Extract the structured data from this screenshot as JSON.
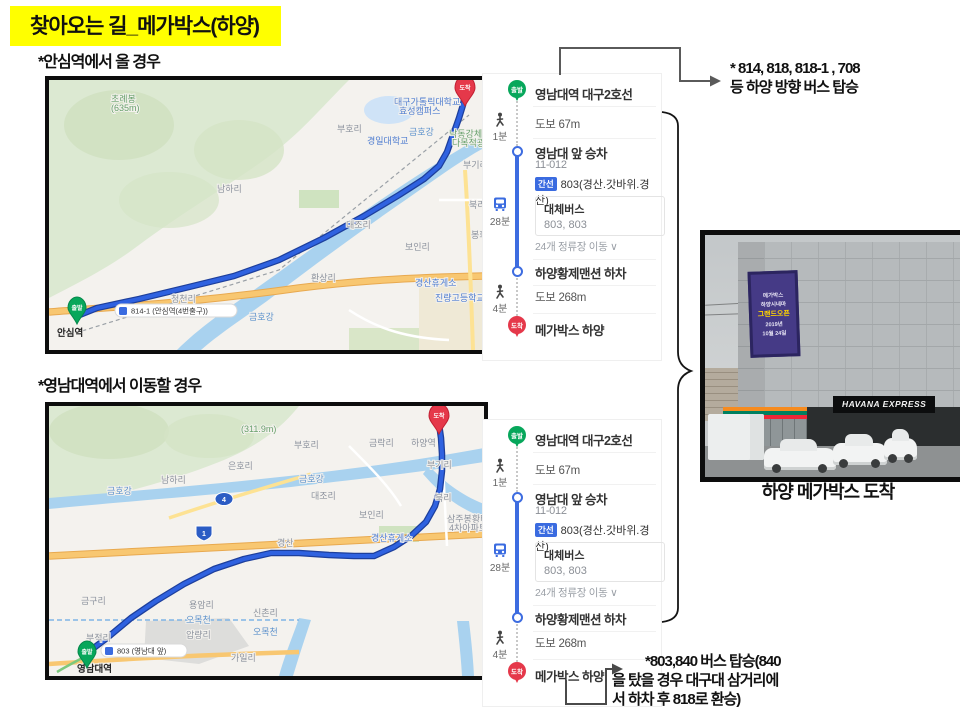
{
  "title": "찾아오는 길_메가박스(하양)",
  "section1": {
    "subtitle": "*안심역에서 올 경우"
  },
  "section2": {
    "subtitle": "*영남대역에서 이동할 경우"
  },
  "transit": {
    "start_pin": "출발",
    "start_station": "영남대역 대구2호선",
    "walk1_time": "1분",
    "walk1_dist": "도보 67m",
    "board_stop": "영남대 앞 승차",
    "board_code": "11-012",
    "line_badge": "간선",
    "line_name": "803(경산.갓바위.경산)",
    "bus_time": "28분",
    "alt_label": "대체버스",
    "alt_buses": "803, 803",
    "stops_toggle": "24개 정류장 이동 ∨",
    "alight_stop": "하양황제맨션 하차",
    "walk2_time": "4분",
    "walk2_dist": "도보 268m",
    "dest_pin": "도착",
    "dest_name": "메가박스 하양"
  },
  "annotation_top": {
    "line1": "* 814, 818, 818-1 , 708",
    "line2": "등 하양 방향 버스 탑승"
  },
  "annotation_bottom": {
    "line1": "*803,840 버스 탑승(840",
    "line2": "을 탔을 경우 대구대 삼거리에",
    "line3": "서 하차 후 818로 환승)"
  },
  "photo": {
    "caption": "하양 메가박스 도착",
    "sign": "HAVANA EXPRESS",
    "banner": {
      "l1": "메가박스",
      "l2": "하양시네마",
      "l3": "그랜드오픈",
      "l4": "2019년",
      "l5": "10월 24일"
    }
  },
  "colors": {
    "highlight": "#ffff00",
    "route": "#2f62e0",
    "route_casing": "#1d3f9c",
    "start_pin": "#07a75b",
    "dest_pin": "#e5384a",
    "line_badge": "#3a6be0",
    "river": "#a9d2ef",
    "terrain": "#dce9d2",
    "road_orange": "#f8c771"
  },
  "maps": [
    {
      "name": "ansim-route-map",
      "start_pin": "출발",
      "dest_pin": "도착",
      "start_badge": "814-1 (안심역(4번출구))",
      "start_label": "안심역",
      "route": [
        [
          28,
          236
        ],
        [
          48,
          228
        ],
        [
          90,
          219
        ],
        [
          140,
          207
        ],
        [
          185,
          196
        ],
        [
          230,
          180
        ],
        [
          275,
          158
        ],
        [
          315,
          136
        ],
        [
          350,
          115
        ],
        [
          375,
          99
        ],
        [
          390,
          86
        ],
        [
          398,
          72
        ],
        [
          404,
          55
        ],
        [
          410,
          38
        ],
        [
          414,
          25
        ],
        [
          416,
          14
        ]
      ],
      "labels": [
        {
          "t": "초례봉",
          "x": 62,
          "y": 22,
          "c": "green"
        },
        {
          "t": "(635m)",
          "x": 62,
          "y": 31,
          "c": "green"
        },
        {
          "t": "남하리",
          "x": 168,
          "y": 112
        },
        {
          "t": "부호리",
          "x": 288,
          "y": 52
        },
        {
          "t": "경일대학교",
          "x": 318,
          "y": 64,
          "c": "blue"
        },
        {
          "t": "대구가톨릭대학교",
          "x": 345,
          "y": 25,
          "c": "blue"
        },
        {
          "t": "효성캠퍼스",
          "x": 350,
          "y": 34,
          "c": "blue"
        },
        {
          "t": "낙동강체육공구",
          "x": 400,
          "y": 57,
          "c": "green"
        },
        {
          "t": "다목적광장",
          "x": 403,
          "y": 66,
          "c": "green"
        },
        {
          "t": "부기리",
          "x": 414,
          "y": 88
        },
        {
          "t": "북리",
          "x": 420,
          "y": 128
        },
        {
          "t": "봉회리",
          "x": 422,
          "y": 158
        },
        {
          "t": "대조리",
          "x": 297,
          "y": 148
        },
        {
          "t": "보인리",
          "x": 356,
          "y": 170
        },
        {
          "t": "환상리",
          "x": 262,
          "y": 201
        },
        {
          "t": "청천리",
          "x": 122,
          "y": 222
        },
        {
          "t": "금호강",
          "x": 200,
          "y": 240,
          "c": "river"
        },
        {
          "t": "금호강",
          "x": 360,
          "y": 55,
          "c": "river"
        },
        {
          "t": "경산휴게소",
          "x": 366,
          "y": 206,
          "c": "blue"
        },
        {
          "t": "진량고등학교",
          "x": 386,
          "y": 221,
          "c": "blue"
        }
      ]
    },
    {
      "name": "yeungnam-route-map",
      "start_pin": "출발",
      "dest_pin": "도착",
      "start_badge": "803 (영남대 앞)",
      "start_label": "영남대역",
      "route": [
        [
          38,
          247
        ],
        [
          58,
          232
        ],
        [
          82,
          212
        ],
        [
          107,
          195
        ],
        [
          135,
          178
        ],
        [
          165,
          163
        ],
        [
          195,
          153
        ],
        [
          222,
          147
        ],
        [
          250,
          147
        ],
        [
          280,
          149
        ],
        [
          305,
          150
        ],
        [
          325,
          150
        ],
        [
          345,
          141
        ],
        [
          362,
          130
        ],
        [
          377,
          116
        ],
        [
          386,
          100
        ],
        [
          391,
          83
        ],
        [
          393,
          65
        ],
        [
          393,
          48
        ],
        [
          392,
          32
        ],
        [
          390,
          18
        ]
      ],
      "labels": [
        {
          "t": "(311.9m)",
          "x": 192,
          "y": 26,
          "c": "green"
        },
        {
          "t": "은호리",
          "x": 179,
          "y": 63
        },
        {
          "t": "남하리",
          "x": 112,
          "y": 77
        },
        {
          "t": "부호리",
          "x": 245,
          "y": 42
        },
        {
          "t": "금락리",
          "x": 320,
          "y": 40
        },
        {
          "t": "하양역",
          "x": 362,
          "y": 40
        },
        {
          "t": "부기리",
          "x": 378,
          "y": 62
        },
        {
          "t": "금호강",
          "x": 250,
          "y": 76,
          "c": "river"
        },
        {
          "t": "금호강",
          "x": 58,
          "y": 88,
          "c": "river"
        },
        {
          "t": "대조리",
          "x": 262,
          "y": 93
        },
        {
          "t": "보인리",
          "x": 310,
          "y": 112
        },
        {
          "t": "북리",
          "x": 386,
          "y": 95
        },
        {
          "t": "삼주봉황타운",
          "x": 398,
          "y": 116
        },
        {
          "t": "4차아파트",
          "x": 400,
          "y": 125
        },
        {
          "t": "경산휴게소",
          "x": 322,
          "y": 135,
          "c": "blue"
        },
        {
          "t": "경산",
          "x": 228,
          "y": 140
        },
        {
          "t": "금구리",
          "x": 32,
          "y": 198
        },
        {
          "t": "용암리",
          "x": 140,
          "y": 202
        },
        {
          "t": "신촌리",
          "x": 204,
          "y": 210
        },
        {
          "t": "오목천",
          "x": 137,
          "y": 217,
          "c": "river"
        },
        {
          "t": "오목천",
          "x": 204,
          "y": 229,
          "c": "river"
        },
        {
          "t": "압량리",
          "x": 137,
          "y": 232
        },
        {
          "t": "가일리",
          "x": 182,
          "y": 255
        },
        {
          "t": "부적리",
          "x": 37,
          "y": 235
        },
        {
          "t": "영남대역",
          "x": 28,
          "y": 266,
          "c": "dark"
        }
      ]
    }
  ]
}
